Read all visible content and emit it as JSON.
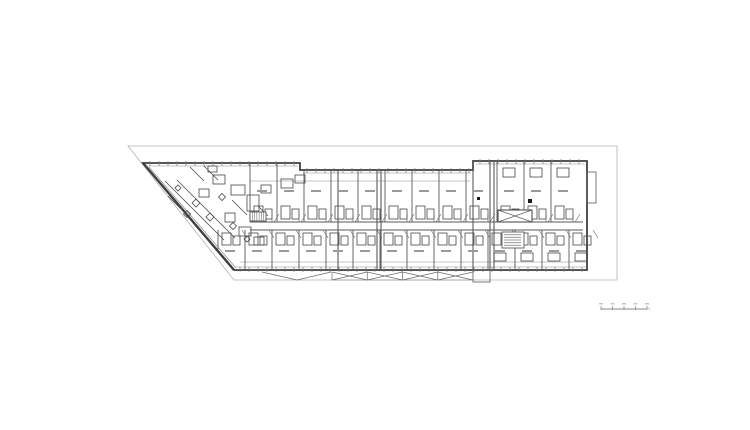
{
  "document": {
    "type": "architectural-floor-plan",
    "description": "Black-and-white apartment building floor plan with diagonal left wing, central corridor, repeated residential units, elevator core and site boundary line"
  },
  "colors": {
    "background": "#ffffff",
    "wall": "#3f3f3f",
    "mid": "#5a5a5a",
    "light": "#8a8a8a",
    "faint": "#b3b3b3",
    "text_smudge": "#9a9a9a",
    "solid_black": "#1a1a1a"
  },
  "plan": {
    "site_boundary": [
      [
        128,
        146
      ],
      [
        617,
        146
      ],
      [
        617,
        280
      ],
      [
        234,
        280
      ]
    ],
    "building_outline": [
      [
        143,
        163
      ],
      [
        300,
        163
      ],
      [
        300,
        170
      ],
      [
        473,
        170
      ],
      [
        473,
        161
      ],
      [
        587,
        161
      ],
      [
        587,
        270
      ],
      [
        234,
        270
      ]
    ],
    "top_edges": [
      {
        "x1": 143,
        "x2": 300,
        "y": 163
      },
      {
        "x1": 300,
        "x2": 473,
        "y": 170
      },
      {
        "x1": 473,
        "x2": 587,
        "y": 161
      }
    ],
    "bottom_edge": {
      "x1": 236,
      "x2": 587,
      "y": 270
    },
    "diagonal": {
      "x1": 143,
      "y1": 163,
      "x2": 234,
      "y2": 270
    },
    "inner_diagonal": {
      "x1": 149,
      "y1": 167,
      "x2": 236,
      "y2": 268
    },
    "right_protrusion": {
      "x": 587,
      "y": 172,
      "w": 9,
      "h": 31
    },
    "bottom_step": {
      "x": 473,
      "y": 270,
      "w": 17,
      "h": 12
    },
    "corridor": {
      "x1": 250,
      "x2": 583,
      "y1": 222,
      "y2": 230
    },
    "sill_lines": [
      {
        "x1": 250,
        "x2": 470,
        "y": 181
      },
      {
        "x1": 240,
        "x2": 585,
        "y": 262
      }
    ],
    "block_dividers": [
      [
        338,
        170,
        270
      ],
      [
        377,
        170,
        270
      ],
      [
        381,
        170,
        270
      ],
      [
        473,
        161,
        270
      ],
      [
        490,
        161,
        270
      ],
      [
        494,
        161,
        270
      ]
    ],
    "top_unit_dividers": [
      [
        250,
        163,
        222
      ],
      [
        277,
        163,
        222
      ],
      [
        304,
        170,
        222
      ],
      [
        331,
        170,
        222
      ],
      [
        358,
        170,
        222
      ],
      [
        385,
        170,
        222
      ],
      [
        412,
        170,
        222
      ],
      [
        439,
        170,
        222
      ],
      [
        466,
        170,
        222
      ],
      [
        497,
        161,
        222
      ],
      [
        524,
        161,
        222
      ],
      [
        551,
        161,
        222
      ]
    ],
    "bottom_unit_dividers": [
      [
        218,
        230,
        250
      ],
      [
        245,
        230,
        270
      ],
      [
        272,
        230,
        270
      ],
      [
        299,
        230,
        270
      ],
      [
        326,
        230,
        270
      ],
      [
        353,
        230,
        270
      ],
      [
        380,
        230,
        270
      ],
      [
        407,
        230,
        270
      ],
      [
        434,
        230,
        270
      ],
      [
        461,
        230,
        270
      ],
      [
        488,
        230,
        270
      ],
      [
        515,
        230,
        270
      ],
      [
        542,
        230,
        270
      ],
      [
        569,
        230,
        270
      ]
    ],
    "tick_step": 9,
    "core": {
      "x": 498,
      "y": 210,
      "w": 34,
      "h": 12
    },
    "text_block": {
      "x": 502,
      "y": 232,
      "w": 22,
      "h": 16,
      "lines": 5
    },
    "stair": {
      "x": 250,
      "y": 212,
      "w": 16,
      "h": 9,
      "treads": 7
    },
    "black_squares": [
      [
        528,
        199,
        4,
        4
      ],
      [
        477,
        197,
        3,
        3
      ]
    ],
    "zigzag": {
      "x1": 332,
      "x2": 473,
      "y1": 272,
      "y2": 280,
      "segments": 4
    },
    "entry_v": [
      [
        262,
        272
      ],
      [
        297,
        280
      ],
      [
        331,
        272
      ]
    ],
    "lobby_lines": [
      [
        165,
        181,
        224,
        240
      ],
      [
        177,
        180,
        235,
        238
      ],
      [
        190,
        167,
        204,
        181
      ],
      [
        204,
        166,
        218,
        180
      ],
      [
        168,
        196,
        180,
        208
      ],
      [
        232,
        200,
        247,
        215
      ],
      [
        258,
        206,
        268,
        216
      ]
    ],
    "lobby_rects": [
      [
        213,
        175,
        12,
        9
      ],
      [
        231,
        185,
        14,
        10
      ],
      [
        247,
        195,
        12,
        16
      ],
      [
        261,
        185,
        10,
        8
      ],
      [
        199,
        189,
        10,
        8
      ],
      [
        225,
        213,
        10,
        9
      ],
      [
        239,
        227,
        12,
        9
      ],
      [
        254,
        237,
        10,
        8
      ],
      [
        281,
        179,
        12,
        9
      ],
      [
        295,
        175,
        10,
        8
      ],
      [
        208,
        166,
        9,
        6
      ]
    ],
    "lobby_diamonds": [
      [
        196,
        203,
        8
      ],
      [
        210,
        217,
        8
      ],
      [
        187,
        214,
        7
      ],
      [
        222,
        197,
        7
      ],
      [
        233,
        226,
        7
      ],
      [
        247,
        239,
        6
      ],
      [
        178,
        188,
        6
      ]
    ],
    "right_block_extra_top": [
      497,
      524,
      551
    ],
    "right_block_extra_bottom": [
      488,
      515,
      542,
      569
    ]
  },
  "scale_bar": {
    "x": 601,
    "y": 309,
    "w": 46,
    "ticks": 5
  }
}
